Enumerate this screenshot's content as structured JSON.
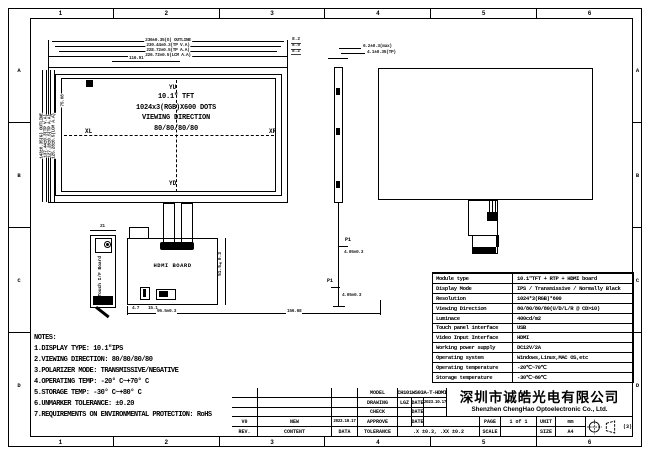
{
  "sheet": {
    "zone_numbers": [
      "1",
      "2",
      "3",
      "4",
      "5",
      "6"
    ],
    "zone_letters": [
      "A",
      "B",
      "C",
      "D"
    ]
  },
  "front_view": {
    "display_text": [
      "10.1\" TFT",
      "1024x3(RGB)X600 DOTS",
      "VIEWING DIRECTION",
      "80/80/80/80"
    ],
    "axis_labels": {
      "up": "YU",
      "down": "YD",
      "left": "XL",
      "right": "XR"
    },
    "dims_top": [
      "236±0.35(G) OUTLINE",
      "230.44±0.3(TP V.A)",
      "228.72±0.5(TP A.A)",
      "226.72±0.5(LCM A.A)"
    ],
    "dim_top_short": "116.91",
    "dims_right_stack": [
      "8.2",
      "8.5",
      "8.2"
    ],
    "dims_left": [
      "143±0.35(G) OUTLINE",
      "137.44±0.3(TP V.A)",
      "127.28±0.5(TP A.A)",
      "125.28±0.5(LCM A.A)"
    ],
    "dim_left_inner": "75.08"
  },
  "side_view": {
    "dim_thickness_max": "6.2±0.3(max)",
    "dim_thickness_tp": "4.1±0.35(TP)",
    "pin_label_1": "P1",
    "pin_label_2": "P1",
    "dim_pin_1": "4.05±0.3",
    "dim_pin_2": "4.05±0.3"
  },
  "hdmi_board": {
    "label": "HDMI BOARD",
    "dim_left_a": "4.7",
    "dim_left_b": "15.1",
    "dim_width": "95.5±0.3",
    "dim_overall": "156.68",
    "dim_height": "51.5±0.3"
  },
  "touch_board": {
    "label": "Touch I/F Board",
    "dim_width": "21"
  },
  "notes": {
    "title": "NOTES:",
    "items": [
      "1.DISPLAY TYPE:  10.1\"IPS",
      "2.VIEWING DIRECTION: 80/80/80/80",
      "3.POLARIZER MODE: TRANSMISSIVE/NEGATIVE",
      "4.OPERATING TEMP: -20° C~+70° C",
      "5.STORAGE TEMP: -30° C~+80° C",
      "6.UNMARKER TOLERANCE: ±0.20",
      "7.REQUIREMENTS ON ENVIRONMENTAL PROTECTION: RoHS"
    ]
  },
  "spec_table": {
    "rows": [
      {
        "label": "Module type",
        "value": "10.1\"TFT + RTP + HDMI board"
      },
      {
        "label": "Display Mode",
        "value": "IPS / Transmissive / Normally Black"
      },
      {
        "label": "Resolution",
        "value": "1024*3(RGB)*600"
      },
      {
        "label": "Viewing Direction",
        "value": "80/80/80/80(U/D/L/R @ CD>10)"
      },
      {
        "label": "Luminace",
        "value": "400cd/m2"
      },
      {
        "label": "Touch panel interface",
        "value": "USB"
      },
      {
        "label": "Video Input Interface",
        "value": "HDMI"
      },
      {
        "label": "Working power supply",
        "value": "DC12V/2A"
      },
      {
        "label": "Operating system",
        "value": "Windows,Linux,MAC OS,etc"
      },
      {
        "label": "Operating temperature",
        "value": "-20℃~70℃"
      },
      {
        "label": "Storage temperature",
        "value": "-30℃~80℃"
      }
    ]
  },
  "title_block": {
    "model_label": "MODEL",
    "model_value": "CH101WS03A-T-HDMI",
    "drawing_label": "DRAWING",
    "drawing_value": "LGZ",
    "date_label": "DATE",
    "drawing_date": "2023.10.17",
    "check_label": "CHECK",
    "approve_label": "APPROVE",
    "tolerance_label": "TOLERANCE",
    "tolerance_value": ".X ±0.3, .XX ±0.2",
    "company_cn": "深圳市诚皓光电有限公司",
    "company_en": "Shenzhen ChengHao Optoelectronic Co., Ltd.",
    "page_label": "PAGE",
    "page_value": "1 of 1",
    "unit_label": "UNIT",
    "unit_value": "mm",
    "scale_label": "SCALE",
    "scale_value": "",
    "size_label": "SIZE",
    "size_value": "A4",
    "projection_note": "(3)",
    "rev_header": {
      "rev": "REV.",
      "content": "CONTENT",
      "date": "DATA"
    },
    "rev_rows": [
      {
        "rev": "V0",
        "content": "NEW",
        "date": "2023.10.17"
      }
    ]
  }
}
